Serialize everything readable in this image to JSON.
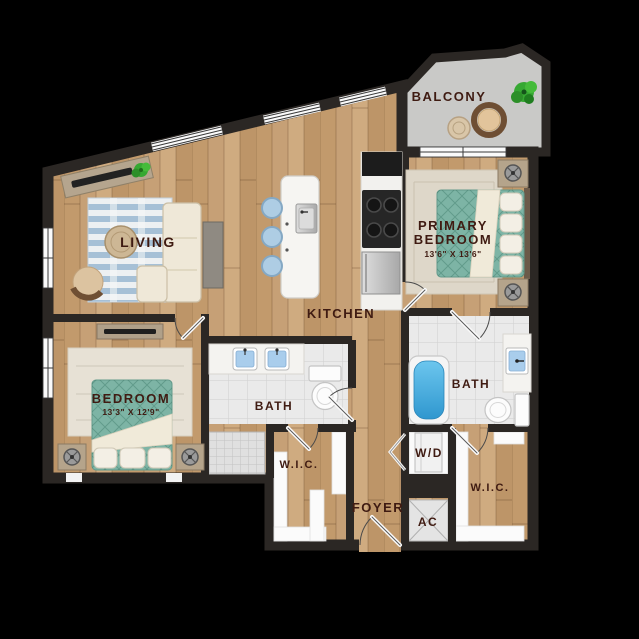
{
  "rooms": {
    "balcony": {
      "label": "BALCONY"
    },
    "living": {
      "label": "LIVING"
    },
    "kitchen": {
      "label": "KITCHEN"
    },
    "primary_bedroom": {
      "label_line1": "PRIMARY",
      "label_line2": "BEDROOM",
      "dimensions": "13'6\" X 13'6\""
    },
    "bedroom": {
      "label": "BEDROOM",
      "dimensions": "13'3\" X 12'9\""
    },
    "bath_main": {
      "label": "BATH"
    },
    "bath_primary": {
      "label": "BATH"
    },
    "wic_left": {
      "label": "W.I.C."
    },
    "wic_right": {
      "label": "W.I.C."
    },
    "washer_dryer": {
      "label": "W/D"
    },
    "foyer": {
      "label": "FOYER"
    },
    "ac": {
      "label": "AC"
    }
  },
  "colors": {
    "wall": "#2b2724",
    "wood": "#c6a076",
    "label": "#3f1b12",
    "tile": "#eaeaea",
    "bed": "#7db4a5",
    "water": "#3fa8da",
    "balcony": "#c9c9c7",
    "cream": "#efe8d8",
    "rugblue": "#a6c0d6",
    "shelf": "#fbfbfb"
  }
}
